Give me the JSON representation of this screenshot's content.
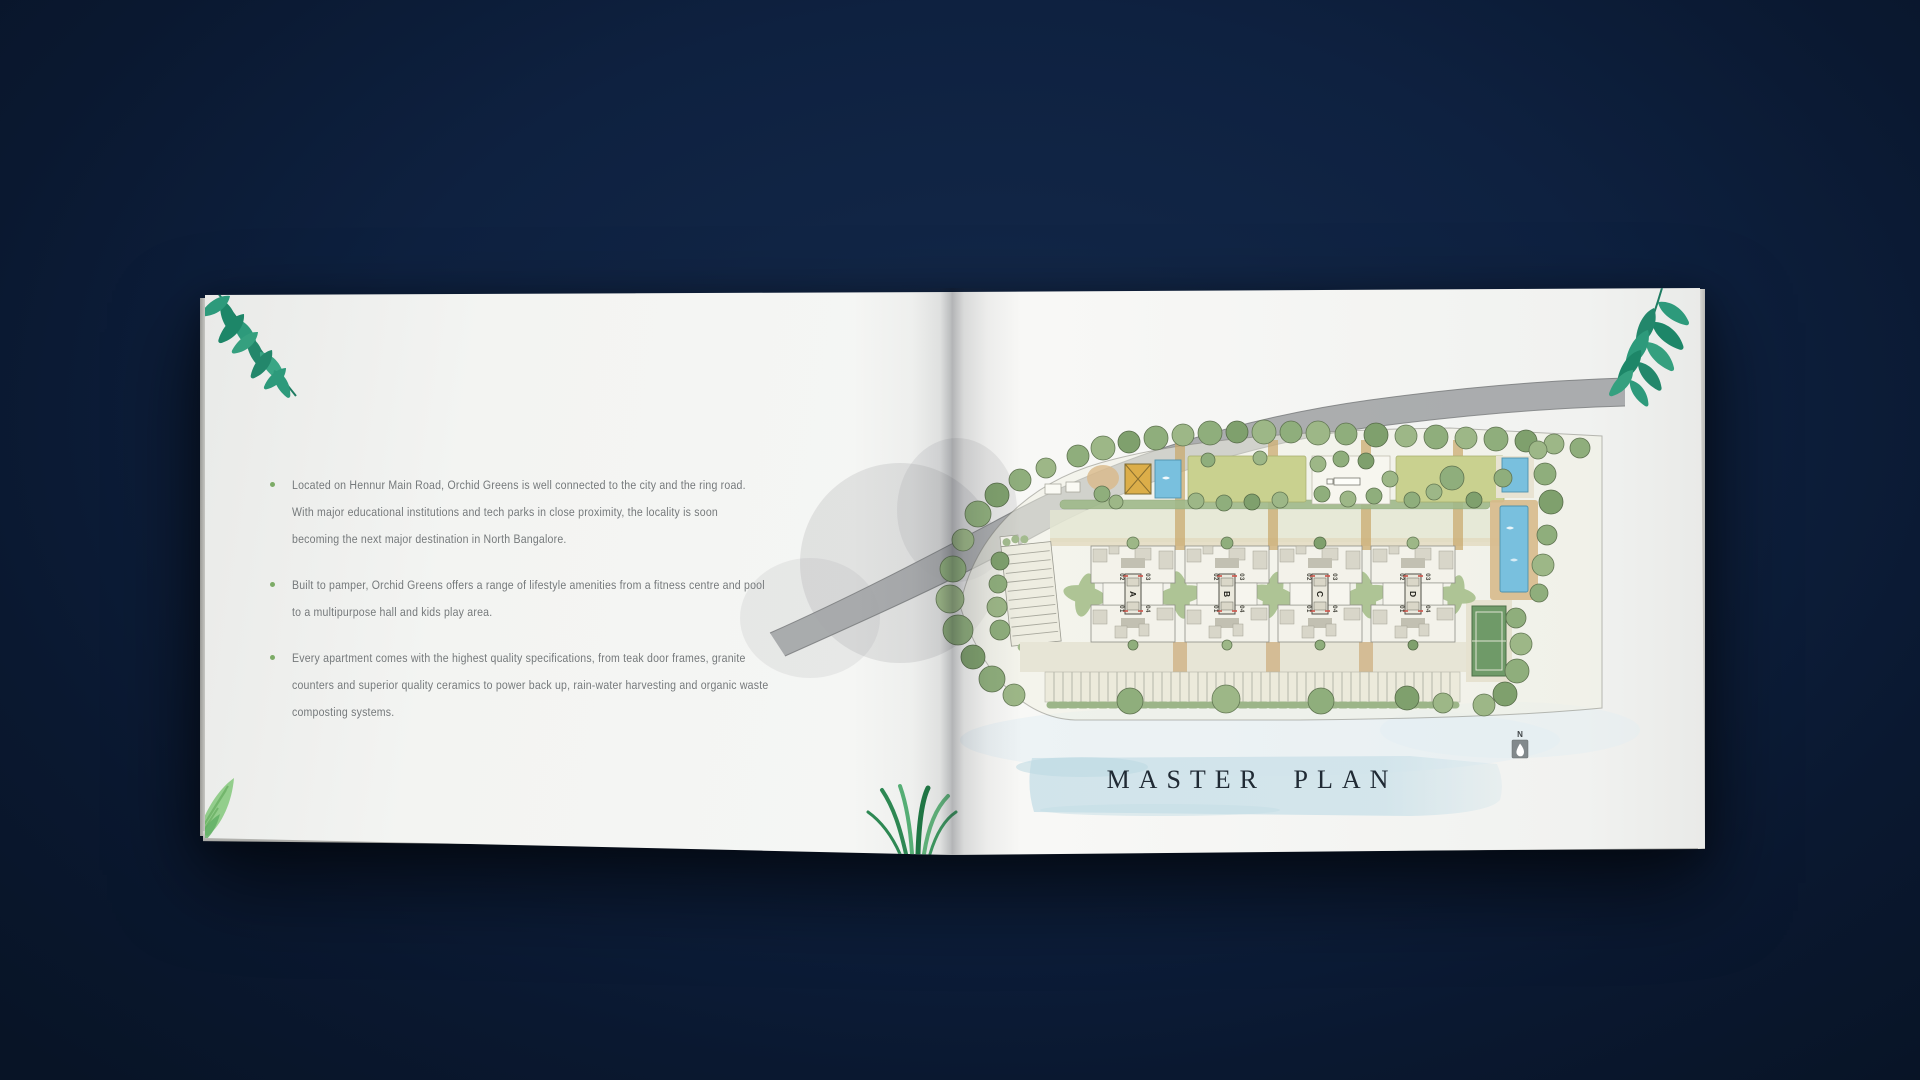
{
  "left_page": {
    "bullets": [
      {
        "text": "Located on Hennur Main Road, Orchid Greens is well connected to the city and the ring road.\nWith major educational institutions and tech parks in close proximity, the locality is soon\nbecoming the next major destination in North Bangalore."
      },
      {
        "text": "Built to pamper, Orchid Greens offers a range of lifestyle amenities from a fitness centre and pool\nto a multipurpose hall and kids play area."
      },
      {
        "text": "Every apartment comes with the highest quality specifications, from teak door frames, granite\ncounters and superior quality ceramics to power back up, rain-water harvesting and organic waste\ncomposting systems."
      }
    ]
  },
  "right_page": {
    "title": "MASTER PLAN",
    "compass": {
      "label": "N"
    },
    "plan": {
      "blocks": [
        {
          "name": "A",
          "units": [
            "01",
            "02",
            "03",
            "04"
          ]
        },
        {
          "name": "B",
          "units": [
            "01",
            "02",
            "03",
            "04"
          ]
        },
        {
          "name": "C",
          "units": [
            "01",
            "02",
            "03",
            "04"
          ]
        },
        {
          "name": "D",
          "units": [
            "01",
            "02",
            "03",
            "04"
          ]
        }
      ]
    }
  },
  "colors": {
    "background_navy": "#0e2140",
    "bullet_green": "#7cab66",
    "body_text_gray": "#75797b",
    "title_ink": "#202a34",
    "watercolor_band_blue": "#cfe3ea",
    "pool_blue": "#79c0de",
    "lawn_green": "#c9d18f",
    "tree_green": "#8fae7c",
    "road_gray": "#a4a6a8",
    "clubhouse_ochre": "#dcae49",
    "tennis_court_green": "#6f9a68",
    "leaf_teal": "#2d9a7b"
  }
}
